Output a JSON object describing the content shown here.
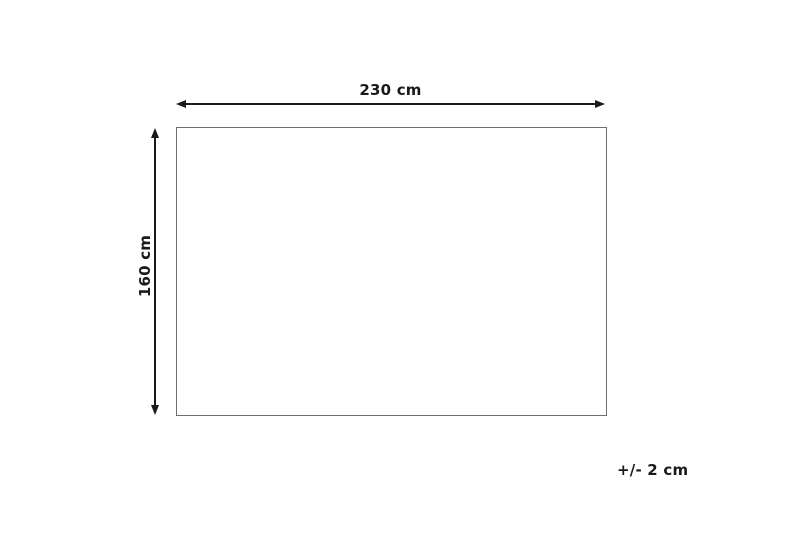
{
  "diagram": {
    "type": "product-dimension-drawing",
    "width_label": "230 cm",
    "height_label": "160 cm",
    "tolerance_label": "+/- 2 cm",
    "colors": {
      "arrow": "#1a1a1a",
      "outline": "#6e6e6e",
      "background": "#ffffff",
      "text": "#1a1a1a"
    }
  }
}
